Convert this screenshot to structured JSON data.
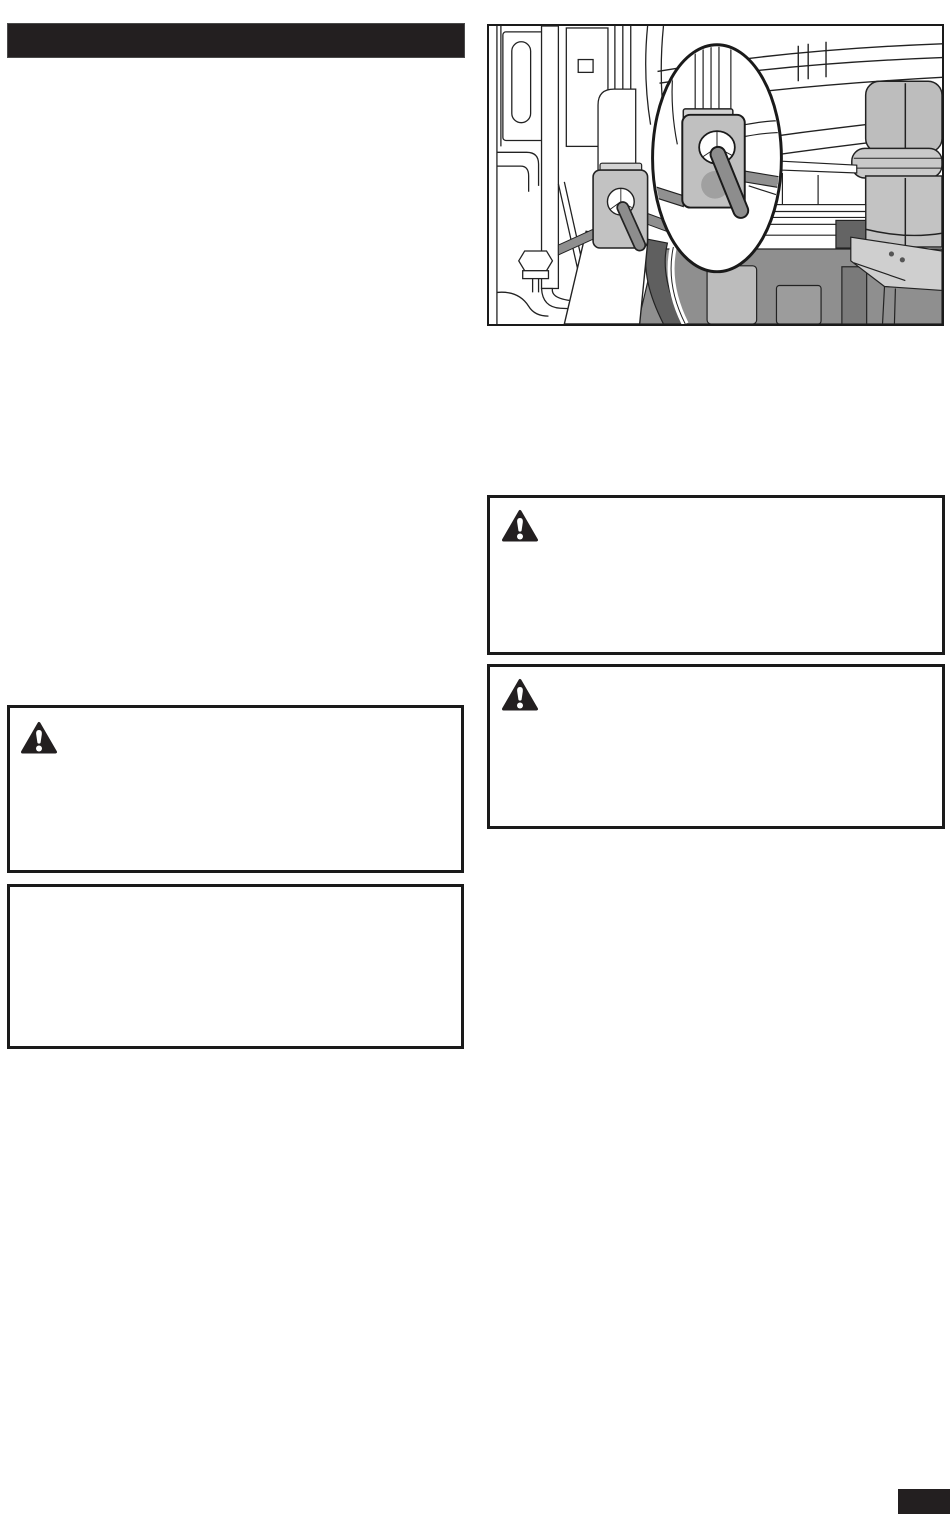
{
  "page": {
    "kind": "scanned-manual-page",
    "bg_color": "#ffffff"
  },
  "colors": {
    "print_black": "#231f20",
    "box_border": "#1a1a1a",
    "figure_line": "#222222",
    "plate_gray": "#c0c0c0",
    "plate_tab_gray": "#d3d3d3",
    "pin_gray": "#8d8d8d",
    "hole_shadow_gray": "#a0a0a0",
    "machinery_mid_gray": "#8f8f8f",
    "machinery_dark_gray": "#5f5f5f",
    "cylinder_gray": "#c3c3c3",
    "deflector_gray": "#cfcfcf"
  },
  "section_header": {
    "text": "",
    "bg_color": "#231f20"
  },
  "figure": {
    "alt": "Black-and-white line illustration of machine frame and deck hardware with a circular magnified inset showing a square keyhole washer plate secured by a retainer pin",
    "caption": ""
  },
  "warning_boxes": [
    {
      "id": "right-top",
      "icon": "warning-triangle-icon",
      "text": ""
    },
    {
      "id": "right-bottom",
      "icon": "warning-triangle-icon",
      "text": ""
    },
    {
      "id": "left",
      "icon": "warning-triangle-icon",
      "text": ""
    }
  ],
  "note_box": {
    "text": ""
  },
  "page_number_tab": {
    "text": "",
    "bg_color": "#231f20"
  }
}
